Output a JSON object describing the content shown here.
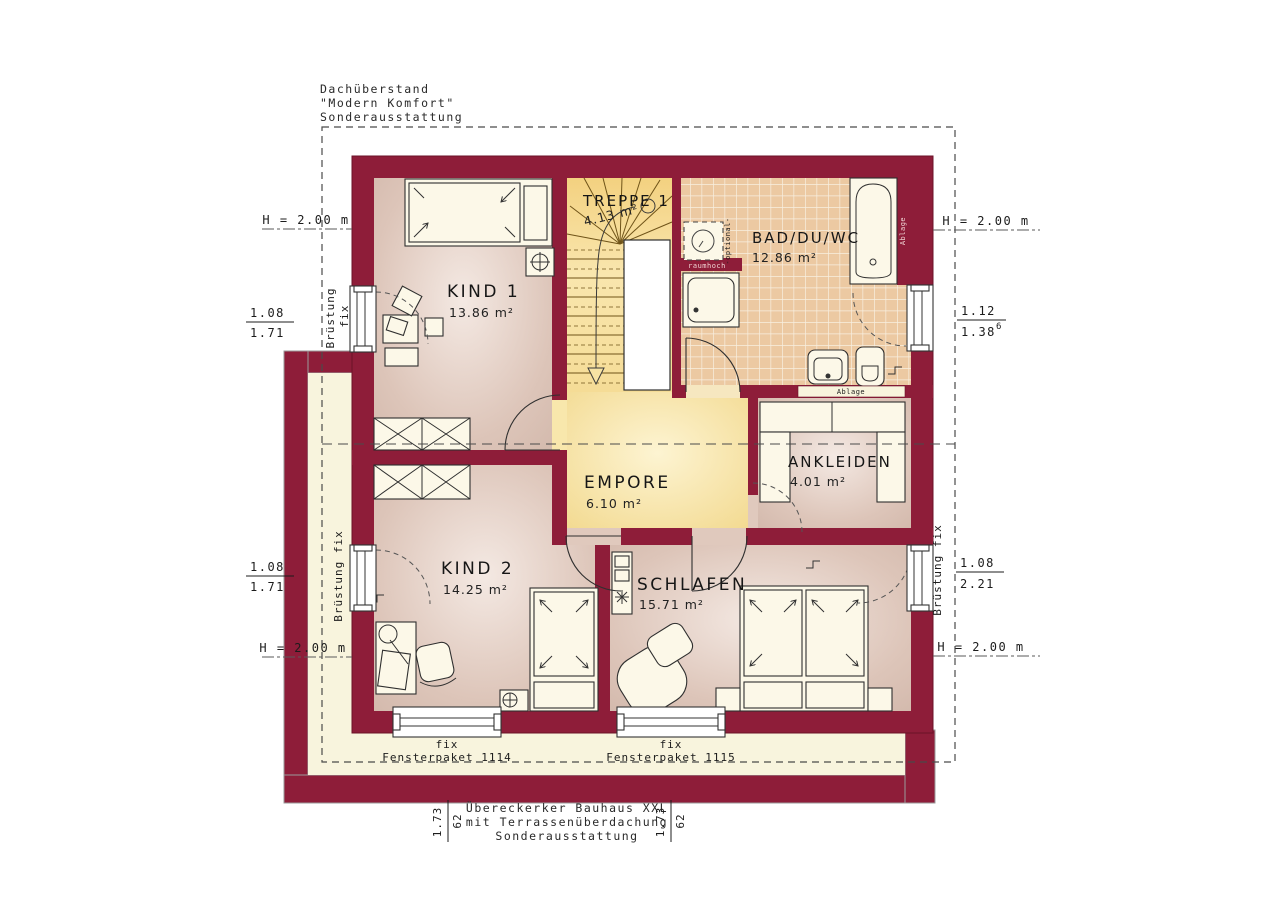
{
  "notes": {
    "roof": [
      "Dachüberstand",
      "\"Modern Komfort\"",
      "Sonderausstattung"
    ],
    "erker": [
      "Übereckerker Bauhaus XXL",
      "mit Terrassenüberdachung",
      "Sonderausstattung"
    ]
  },
  "rooms": {
    "treppe": {
      "name": "TREPPE 1",
      "area": "4.13 m²"
    },
    "bad": {
      "name": "BAD/DU/WC",
      "area": "12.86 m²"
    },
    "kind1": {
      "name": "KIND 1",
      "area": "13.86 m²"
    },
    "empore": {
      "name": "EMPORE",
      "area": "6.10 m²"
    },
    "ankleiden": {
      "name": "ANKLEIDEN",
      "area": "4.01 m²"
    },
    "kind2": {
      "name": "KIND 2",
      "area": "14.25 m²"
    },
    "schlafen": {
      "name": "SCHLAFEN",
      "area": "15.71 m²"
    }
  },
  "labels": {
    "h_height": "H = 2.00 m",
    "bruestung": "Brüstung",
    "fix": "fix",
    "bruestung_fix": "Brüstung fix",
    "raumhoch": "raumhoch",
    "optional": "-optional-",
    "ablage": "Ablage"
  },
  "windows": {
    "left_top": {
      "width": "1.08",
      "height": "1.71"
    },
    "right_top": {
      "width": "1.12",
      "height": "1.38",
      "sup": "6"
    },
    "left_bottom": {
      "width": "1.08",
      "height": "1.71"
    },
    "right_bottom": {
      "width": "1.08",
      "height": "2.21"
    },
    "package_1": {
      "label": "fix",
      "name": "Fensterpaket 1114"
    },
    "package_2": {
      "label": "fix",
      "name": "Fensterpaket 1115"
    },
    "corner_dim": {
      "a": "1.73",
      "b": "62"
    }
  },
  "colors": {
    "wall": "#8e1d39",
    "room_floor": "#dcc5ba",
    "gallery_floor": "#f6dd9a",
    "tile_floor": "#ecc9a2",
    "terrace": "#f8f4dd"
  }
}
